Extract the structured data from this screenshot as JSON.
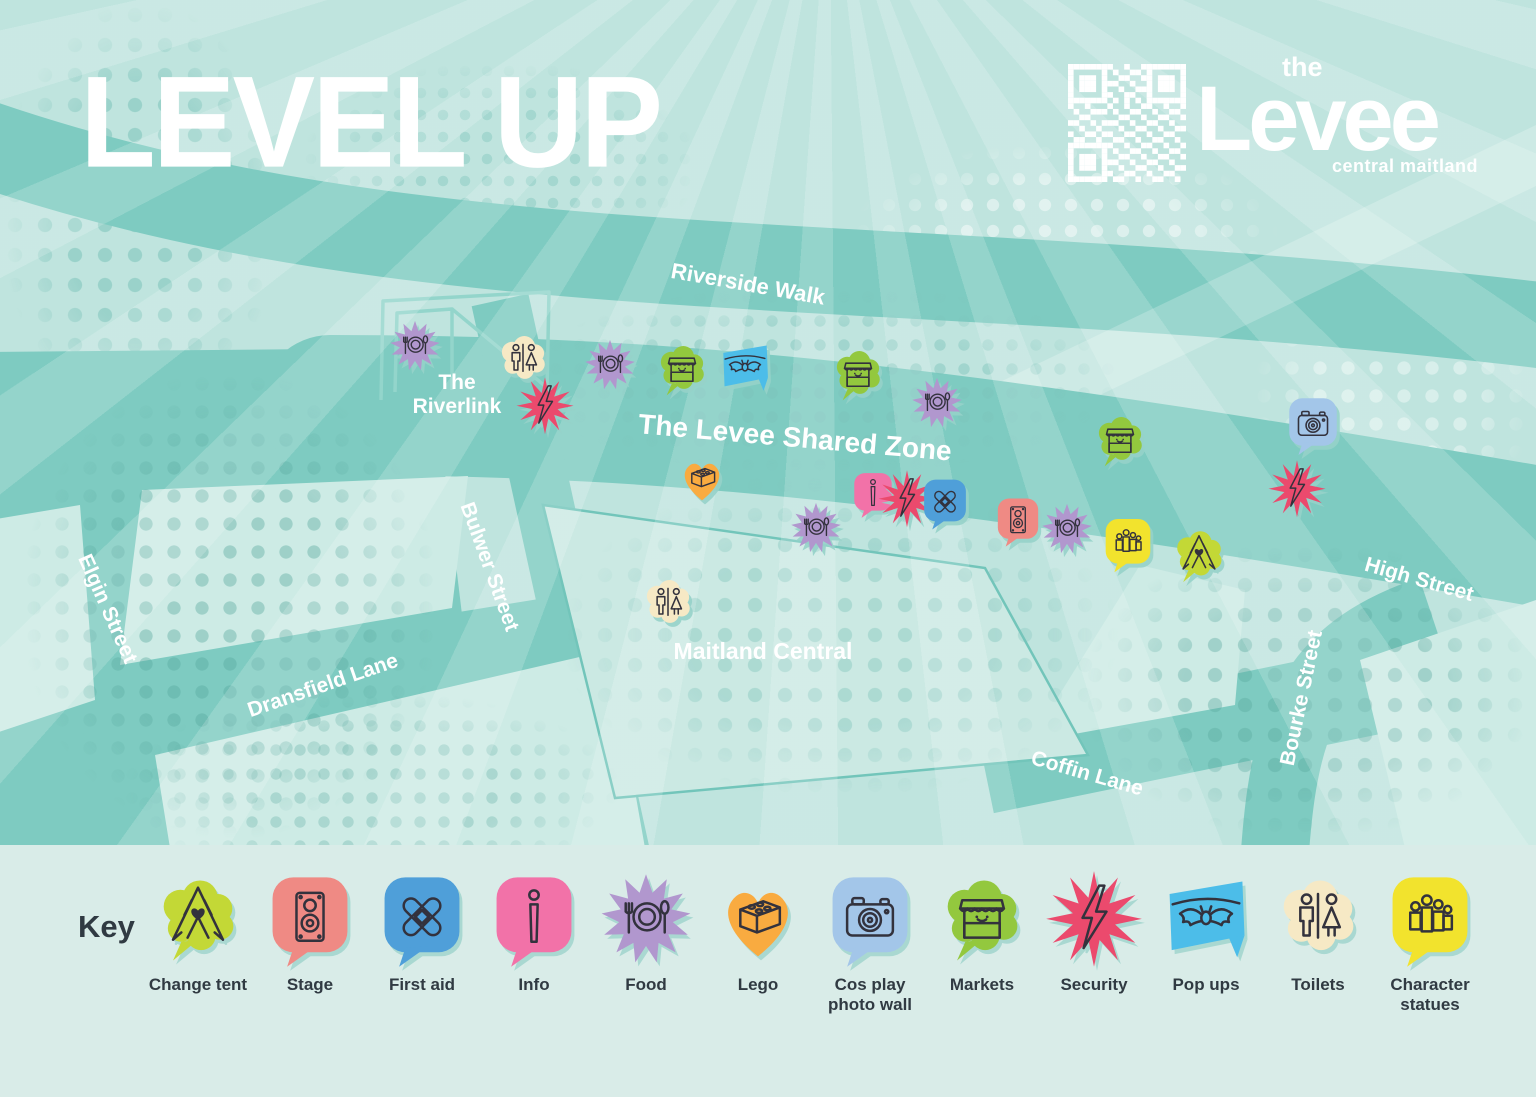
{
  "title": "LEVEL UP",
  "logo": {
    "line1": "the",
    "line2": "Levee",
    "line3": "central maitland"
  },
  "map": {
    "labels": [
      {
        "text": "Riverside Walk",
        "x": 748,
        "y": 284,
        "rotate": 10,
        "size": 22
      },
      {
        "text": "The Riverlink",
        "x": 457,
        "y": 395,
        "rotate": 0,
        "size": 21,
        "w": 120
      },
      {
        "text": "The Levee Shared Zone",
        "x": 795,
        "y": 438,
        "rotate": 5,
        "size": 28
      },
      {
        "text": "Elgin Street",
        "x": 107,
        "y": 609,
        "rotate": 66,
        "size": 21
      },
      {
        "text": "Bulwer Street",
        "x": 489,
        "y": 567,
        "rotate": 70,
        "size": 21
      },
      {
        "text": "Dransfield Lane",
        "x": 323,
        "y": 686,
        "rotate": -19,
        "size": 21
      },
      {
        "text": "Maitland Central",
        "x": 763,
        "y": 651,
        "rotate": 0,
        "size": 23
      },
      {
        "text": "Coffin Lane",
        "x": 1087,
        "y": 774,
        "rotate": 16,
        "size": 21
      },
      {
        "text": "Bourke Street",
        "x": 1302,
        "y": 698,
        "rotate": -78,
        "size": 21
      },
      {
        "text": "High Street",
        "x": 1419,
        "y": 580,
        "rotate": 16,
        "size": 21
      }
    ],
    "markers": [
      {
        "type": "food",
        "x": 415,
        "y": 347
      },
      {
        "type": "toilets",
        "x": 523,
        "y": 361
      },
      {
        "type": "security",
        "x": 545,
        "y": 407
      },
      {
        "type": "food",
        "x": 610,
        "y": 366
      },
      {
        "type": "markets",
        "x": 682,
        "y": 371
      },
      {
        "type": "pop-ups",
        "x": 745,
        "y": 369
      },
      {
        "type": "markets",
        "x": 858,
        "y": 376
      },
      {
        "type": "food",
        "x": 937,
        "y": 404
      },
      {
        "type": "markets",
        "x": 1120,
        "y": 442
      },
      {
        "type": "cos-play",
        "x": 1313,
        "y": 426
      },
      {
        "type": "security",
        "x": 1297,
        "y": 490
      },
      {
        "type": "lego",
        "x": 702,
        "y": 480
      },
      {
        "type": "food",
        "x": 816,
        "y": 529
      },
      {
        "type": "info",
        "x": 873,
        "y": 495
      },
      {
        "type": "security",
        "x": 907,
        "y": 500
      },
      {
        "type": "first-aid",
        "x": 945,
        "y": 504
      },
      {
        "type": "stage",
        "x": 1018,
        "y": 522
      },
      {
        "type": "food",
        "x": 1067,
        "y": 530
      },
      {
        "type": "character-statues",
        "x": 1128,
        "y": 545
      },
      {
        "type": "change-tent",
        "x": 1199,
        "y": 557
      },
      {
        "type": "toilets",
        "x": 668,
        "y": 605
      }
    ]
  },
  "key": {
    "heading": "Key",
    "items": [
      {
        "id": "change-tent",
        "label": "Change tent",
        "color": "#c3d836",
        "shape": "cloud",
        "tail": true,
        "msize": 66
      },
      {
        "id": "stage",
        "label": "Stage",
        "color": "#ef8a84",
        "shape": "speech",
        "msize": 56
      },
      {
        "id": "first-aid",
        "label": "First aid",
        "color": "#4f9fd9",
        "shape": "speech",
        "msize": 58
      },
      {
        "id": "info",
        "label": "Info",
        "color": "#f272a8",
        "shape": "speech",
        "msize": 52
      },
      {
        "id": "food",
        "label": "Food",
        "color": "#b197ce",
        "shape": "burst",
        "msize": 58
      },
      {
        "id": "lego",
        "label": "Lego",
        "color": "#f9ab40",
        "shape": "heart",
        "msize": 60
      },
      {
        "id": "cos-play",
        "label": "Cos play photo wall",
        "color": "#a3c6e9",
        "shape": "speech",
        "msize": 66
      },
      {
        "id": "markets",
        "label": "Markets",
        "color": "#93c83e",
        "shape": "cloud",
        "tail": true,
        "msize": 64
      },
      {
        "id": "security",
        "label": "Security",
        "color": "#eb4a6d",
        "shape": "burst",
        "spiky": true,
        "msize": 62
      },
      {
        "id": "pop-ups",
        "label": "Pop ups",
        "color": "#4cbde9",
        "shape": "flag",
        "msize": 62
      },
      {
        "id": "toilets",
        "label": "Toilets",
        "color": "#f6e9c5",
        "shape": "cloud",
        "msize": 64
      },
      {
        "id": "character-statues",
        "label": "Character statues",
        "color": "#f2e32d",
        "shape": "speech",
        "msize": 62
      }
    ]
  },
  "colors": {
    "background": "#bfe4de",
    "road": "#7ecbc1",
    "block": "#cdebe5",
    "key_background": "#d9ece8",
    "text_dark": "#303a42",
    "text_light": "#ffffff"
  }
}
